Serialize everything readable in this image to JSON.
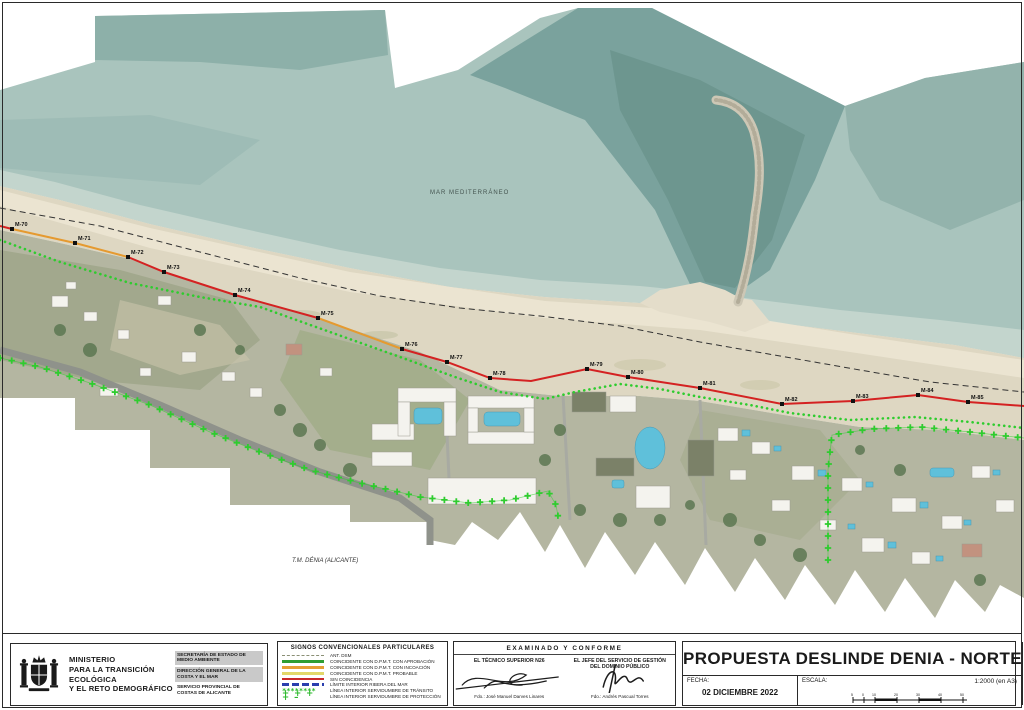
{
  "map": {
    "sea_label": "MAR MEDITERRÁNEO",
    "municipality_label": "T.M. DÉNIA (ALICANTE)",
    "markers": [
      {
        "label": "M-70",
        "x": 12,
        "y": 229
      },
      {
        "label": "M-71",
        "x": 75,
        "y": 243
      },
      {
        "label": "M-72",
        "x": 128,
        "y": 257
      },
      {
        "label": "M-73",
        "x": 164,
        "y": 272
      },
      {
        "label": "M-74",
        "x": 235,
        "y": 295
      },
      {
        "label": "M-75",
        "x": 318,
        "y": 318
      },
      {
        "label": "M-76",
        "x": 402,
        "y": 349
      },
      {
        "label": "M-77",
        "x": 447,
        "y": 362
      },
      {
        "label": "M-78",
        "x": 490,
        "y": 378
      },
      {
        "label": "M-79",
        "x": 587,
        "y": 369
      },
      {
        "label": "M-80",
        "x": 628,
        "y": 377
      },
      {
        "label": "M-81",
        "x": 700,
        "y": 388
      },
      {
        "label": "M-82",
        "x": 782,
        "y": 404
      },
      {
        "label": "M-83",
        "x": 853,
        "y": 401
      },
      {
        "label": "M-84",
        "x": 918,
        "y": 395
      },
      {
        "label": "M-85",
        "x": 968,
        "y": 402
      }
    ],
    "colors": {
      "deslinde_red": "#d42222",
      "deslinde_orange": "#e59a30",
      "transito_green": "#2ecc2e",
      "proteccion_green": "#2ecc2e",
      "old_line_black": "#333333",
      "marker_black": "#111111"
    }
  },
  "title_block": {
    "ministry": {
      "line1": "MINISTERIO",
      "line2": "PARA LA TRANSICIÓN ECOLÓGICA",
      "line3": "Y EL RETO DEMOGRÁFICO",
      "departments": [
        {
          "label": "SECRETARÍA DE ESTADO DE MEDIO AMBIENTE"
        },
        {
          "label": "DIRECCIÓN GENERAL DE LA COSTA Y EL MAR"
        },
        {
          "label": "SERVICIO PROVINCIAL DE COSTAS DE ALICANTE"
        }
      ]
    },
    "legend": {
      "title": "SIGNOS CONVENCIONALES PARTICULARES",
      "items": [
        {
          "label": "ANT. DSM"
        },
        {
          "label": "COINCIDENTE CON D.P.M.T. CON APROBACIÓN"
        },
        {
          "label": "COINCIDENTE CON D.P.M.T. CON INCOACIÓN"
        },
        {
          "label": "COINCIDENTE CON D.P.M.T. PROBABLE"
        },
        {
          "label": "SIN COINCIDENCIA"
        },
        {
          "label": "LÍMITE INTERIOR RIBERA DEL MAR"
        },
        {
          "label": "LÍNEA INTERIOR SERVIDUMBRE DE TRÁNSITO"
        },
        {
          "label": "LÍNEA INTERIOR SERVIDUMBRE DE PROTECCIÓN"
        }
      ],
      "star_glyphs": "********",
      "plus_glyphs": "+ + + + –"
    },
    "approval": {
      "header": "EXAMINADO Y CONFORME",
      "left_role": "EL TÉCNICO SUPERIOR N26",
      "left_signed": "Fdo.: José Manuel Darves Linares",
      "right_role1": "EL JEFE DEL SERVICIO DE GESTIÓN",
      "right_role2": "DEL DOMINIO PÚBLICO",
      "right_signed": "Fdo.: Andrés Pascual Torres"
    },
    "title": {
      "text": "PROPUESTA DESLINDE DENIA - NORTE",
      "fecha_label": "FECHA:",
      "fecha_value": "02 DICIEMBRE 2022",
      "escala_label": "ESCALA:",
      "escala_value": "1:2000 (en A3)",
      "plano_label": "PLANO:",
      "plano_number": "7",
      "plano_total": "/19",
      "scale_ticks": [
        "5",
        "0",
        "10",
        "20",
        "30",
        "40",
        "50"
      ]
    }
  }
}
